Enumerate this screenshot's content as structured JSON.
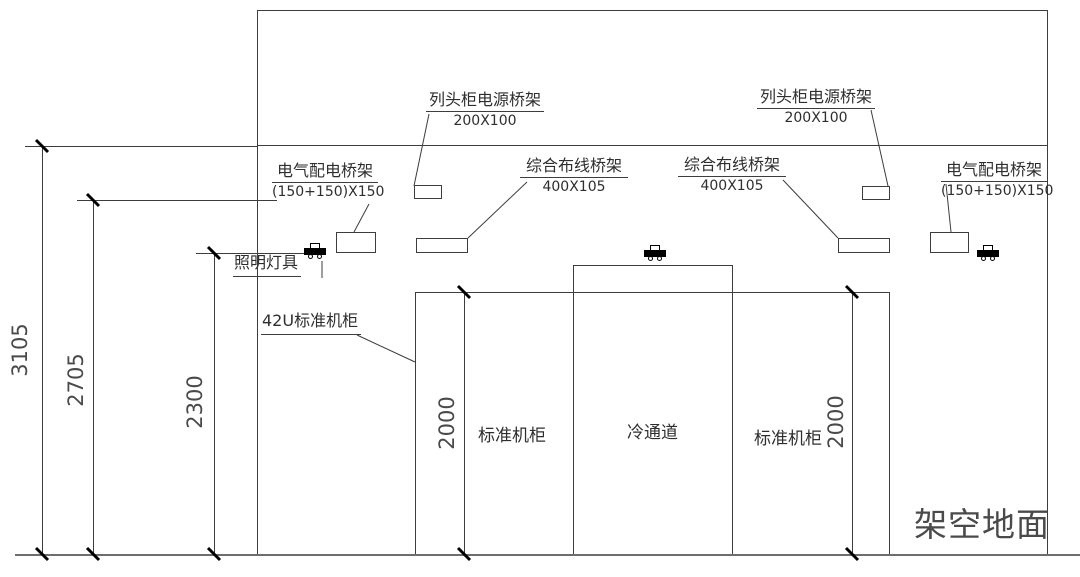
{
  "labels": {
    "power_tray_left": {
      "title": "列头柜电源桥架",
      "size": "200X100"
    },
    "power_tray_right": {
      "title": "列头柜电源桥架",
      "size": "200X100"
    },
    "electrical_tray_left": {
      "title": "电气配电桥架",
      "size": "(150+150)X150"
    },
    "electrical_tray_right": {
      "title": "电气配电桥架",
      "size": "(150+150)X150"
    },
    "cabling_tray_left": {
      "title": "综合布线桥架",
      "size": "400X105"
    },
    "cabling_tray_right": {
      "title": "综合布线桥架",
      "size": "400X105"
    },
    "lighting": "照明灯具",
    "rack_42u": "42U标准机柜",
    "cabinet_left": "标准机柜",
    "cold_aisle": "冷通道",
    "cabinet_right": "标准机柜",
    "raised_floor": "架空地面"
  },
  "dimensions": {
    "total_height": "3105",
    "tray_height": "2705",
    "lighting_height": "2300",
    "cabinet_height_left": "2000",
    "cabinet_height_right": "2000"
  },
  "colors": {
    "line": "#3d3d3d",
    "text": "#2e2e2e",
    "background": "#ffffff"
  }
}
